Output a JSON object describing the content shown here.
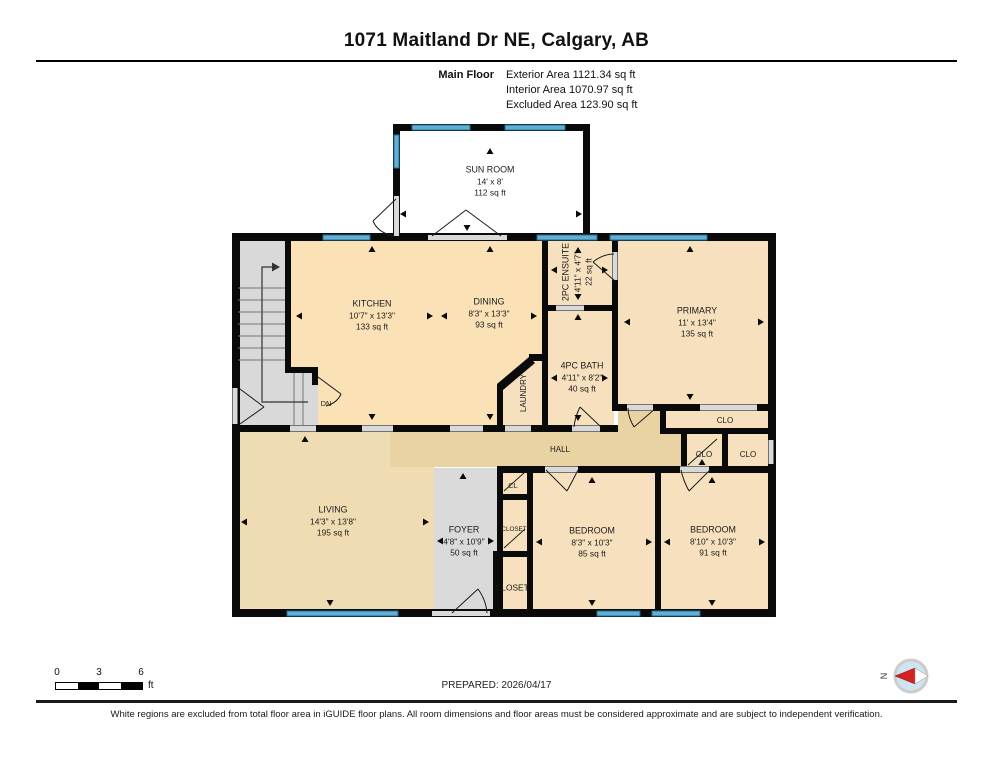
{
  "header": {
    "title": "1071 Maitland Dr NE, Calgary, AB",
    "floor_label": "Main Floor",
    "exterior": "Exterior Area 1121.34 sq ft",
    "interior": "Interior Area 1070.97 sq ft",
    "excluded": "Excluded Area 123.90 sq ft"
  },
  "rooms": {
    "sun_room": {
      "name": "SUN ROOM",
      "dims": "14' x 8'",
      "area": "112 sq ft"
    },
    "kitchen": {
      "name": "KITCHEN",
      "dims": "10'7\" x 13'3\"",
      "area": "133 sq ft"
    },
    "dining": {
      "name": "DINING",
      "dims": "8'3\" x 13'3\"",
      "area": "93 sq ft"
    },
    "ensuite": {
      "name": "2PC ENSUITE",
      "dims": "4'11\" x 4'7\"",
      "area": "22 sq ft"
    },
    "bath": {
      "name": "4PC BATH",
      "dims": "4'11\" x 8'2\"",
      "area": "40 sq ft"
    },
    "primary": {
      "name": "PRIMARY",
      "dims": "11' x 13'4\"",
      "area": "135 sq ft"
    },
    "laundry": {
      "name": "LAUNDRY"
    },
    "hall": {
      "name": "HALL"
    },
    "living": {
      "name": "LIVING",
      "dims": "14'3\" x 13'8\"",
      "area": "195 sq ft"
    },
    "foyer": {
      "name": "FOYER",
      "dims": "4'8\" x 10'9\"",
      "area": "50 sq ft"
    },
    "bedroom1": {
      "name": "BEDROOM",
      "dims": "8'3\" x 10'3\"",
      "area": "85 sq ft"
    },
    "bedroom2": {
      "name": "BEDROOM",
      "dims": "8'10\" x 10'3\"",
      "area": "91 sq ft"
    },
    "closet_primary": {
      "name": "CLO"
    },
    "closet_hall_1": {
      "name": "CLO"
    },
    "closet_hall_2": {
      "name": "CLO"
    },
    "closet_cl": {
      "name": "CL"
    },
    "closet_mid": {
      "name": "CLOSET"
    },
    "closet_front": {
      "name": "CLOSET"
    },
    "stairs": {
      "dn_label": "DN"
    }
  },
  "footer": {
    "scale_ticks": [
      "0",
      "3",
      "6"
    ],
    "scale_unit": "ft",
    "prepared": "PREPARED: 2026/04/17",
    "compass_north": "N",
    "disclaimer": "White regions are excluded from total floor area in iGUIDE floor plans. All room dimensions and floor areas must be considered approximate and are subject to independent verification."
  },
  "colors": {
    "window_blue": "#5fb0d6",
    "compass_red": "#d22222",
    "room_tan": "#f6e0be",
    "kitchen_tan": "#fae1b6",
    "hall_tan": "#ead3a2",
    "living_tan": "#f0dcb2",
    "excluded_gray": "#d9d9d9"
  }
}
